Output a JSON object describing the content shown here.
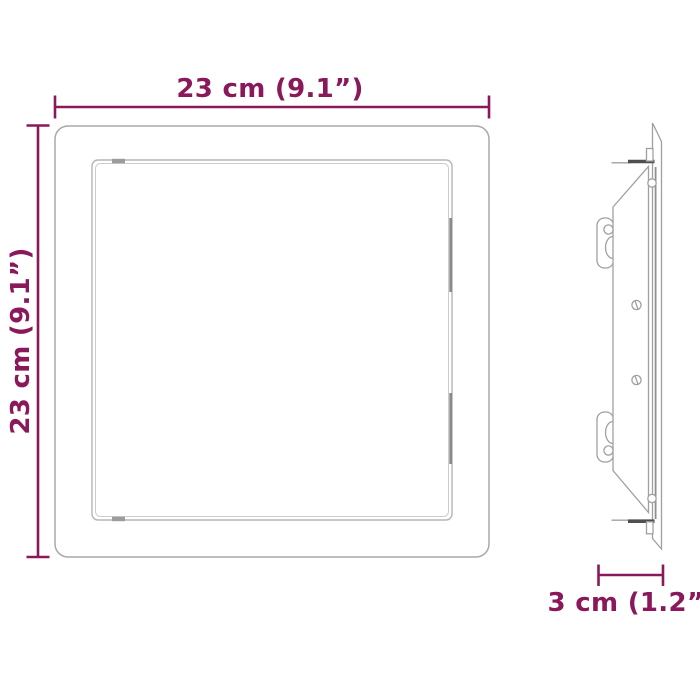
{
  "colors": {
    "accent": "#8a195c",
    "line": "#a9a9a9",
    "background": "#ffffff"
  },
  "dimensions": {
    "width": {
      "label": "23 cm (9.1”)"
    },
    "height": {
      "label": "23 cm (9.1”)"
    },
    "depth": {
      "label": "3 cm (1.2”)"
    }
  }
}
